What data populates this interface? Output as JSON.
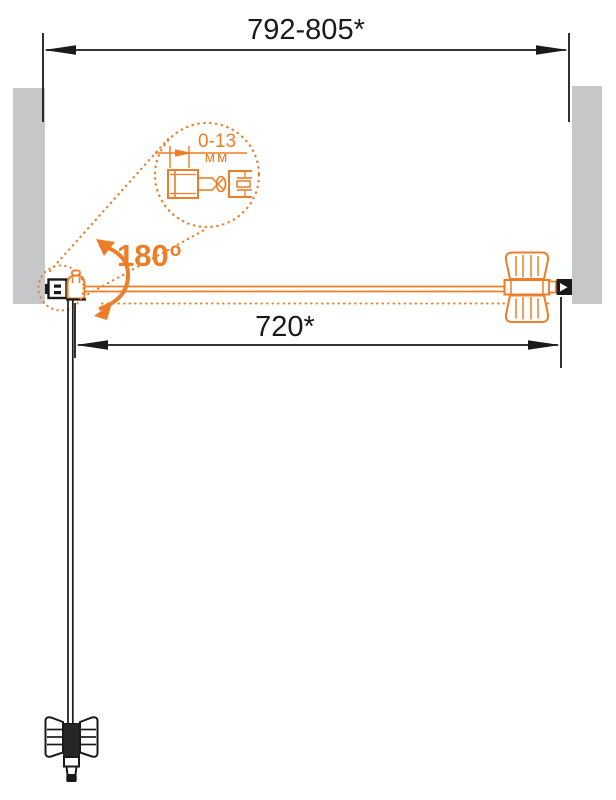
{
  "meta": {
    "type": "technical installation diagram",
    "subject": "pivot shower door, plan view with 180-degree opening"
  },
  "colors": {
    "accent_orange": "#ED7D26",
    "line_black": "#1A1A1A",
    "wall_gray": "#C5C7C9",
    "background": "#FFFFFF"
  },
  "dims": {
    "overall": {
      "label": "792-805*"
    },
    "door": {
      "label": "720*"
    },
    "adjustment": {
      "value": "0-13",
      "unit": "мм"
    },
    "angle": {
      "value": "180",
      "degree_symbol": "o"
    }
  },
  "icons": {
    "rotation_arrow": "curved-double-headed-arrow",
    "detail_callout": "dotted-magnifier-circle",
    "wall_profile_detail": "adjustable-wall-profile-section",
    "left_hinge": "wall-bracket-with-pivot-hinge",
    "right_hinge": "butterfly-glass-clamp",
    "wall_cap": "black-end-cap-with-white-arrow",
    "door_handle": "knob-handle-side-view",
    "door_foot": "bottom-pivot-cap"
  }
}
